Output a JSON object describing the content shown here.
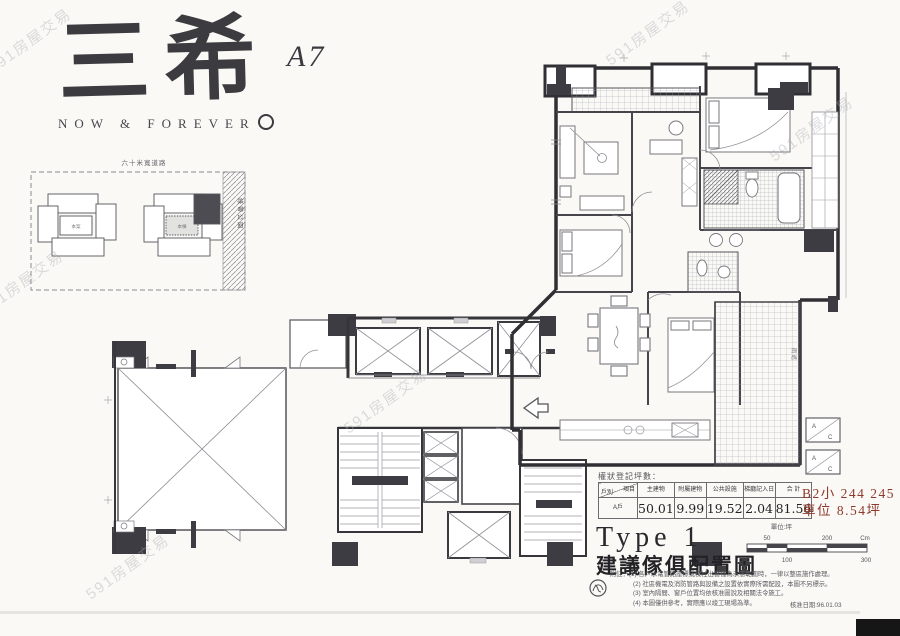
{
  "brand": {
    "name": "三希",
    "tagline": "NOW & FOREVER",
    "unit": "A7"
  },
  "watermark": {
    "text": "591房屋交易"
  },
  "site_plan": {
    "road_label": "六十米寬道路",
    "strip_label": "綠帶公園",
    "left_label": "本案",
    "right_label": "本棟"
  },
  "floor_plan": {
    "ac_top": "A",
    "ac_bottom": "C",
    "canopy_label": "雨遮"
  },
  "area_table": {
    "caption": "權狀登記坪數：",
    "corner_top": "項目",
    "corner_bottom": "戶別",
    "columns": [
      "主建物",
      "附屬建物",
      "公共設施",
      "梯廳記入日",
      "合 計"
    ],
    "row_label": "A戶",
    "values": [
      "50.01",
      "9.99",
      "19.52",
      "2.04",
      "81.56"
    ],
    "unit_note": "單位:坪"
  },
  "parking": {
    "line1": "B2小 244 245",
    "line2": "車位 8.54坪",
    "color": "#8e392c"
  },
  "title_block": {
    "type": "Type 1",
    "name": "建議傢俱配置圖"
  },
  "scale_bar": {
    "top": [
      "50",
      "200",
      "Cm"
    ],
    "bottom": [
      "0",
      "100",
      "300"
    ]
  },
  "notes": {
    "lines": [
      "附註：(1) 各戶水電管路座標或樑柱出窗僅為示意範圍時，一律以整區施作處理。",
      "(2) 社區機電及消防管路與設備之設置依實際所需配設，本圖不另標示。",
      "(3) 室內隔間、窗戶位置均依核准圖說及相關法令施工。",
      "(4) 本圖僅供參考，實際應以竣工現場為準。"
    ],
    "date": "核准日期:96.01.03"
  }
}
